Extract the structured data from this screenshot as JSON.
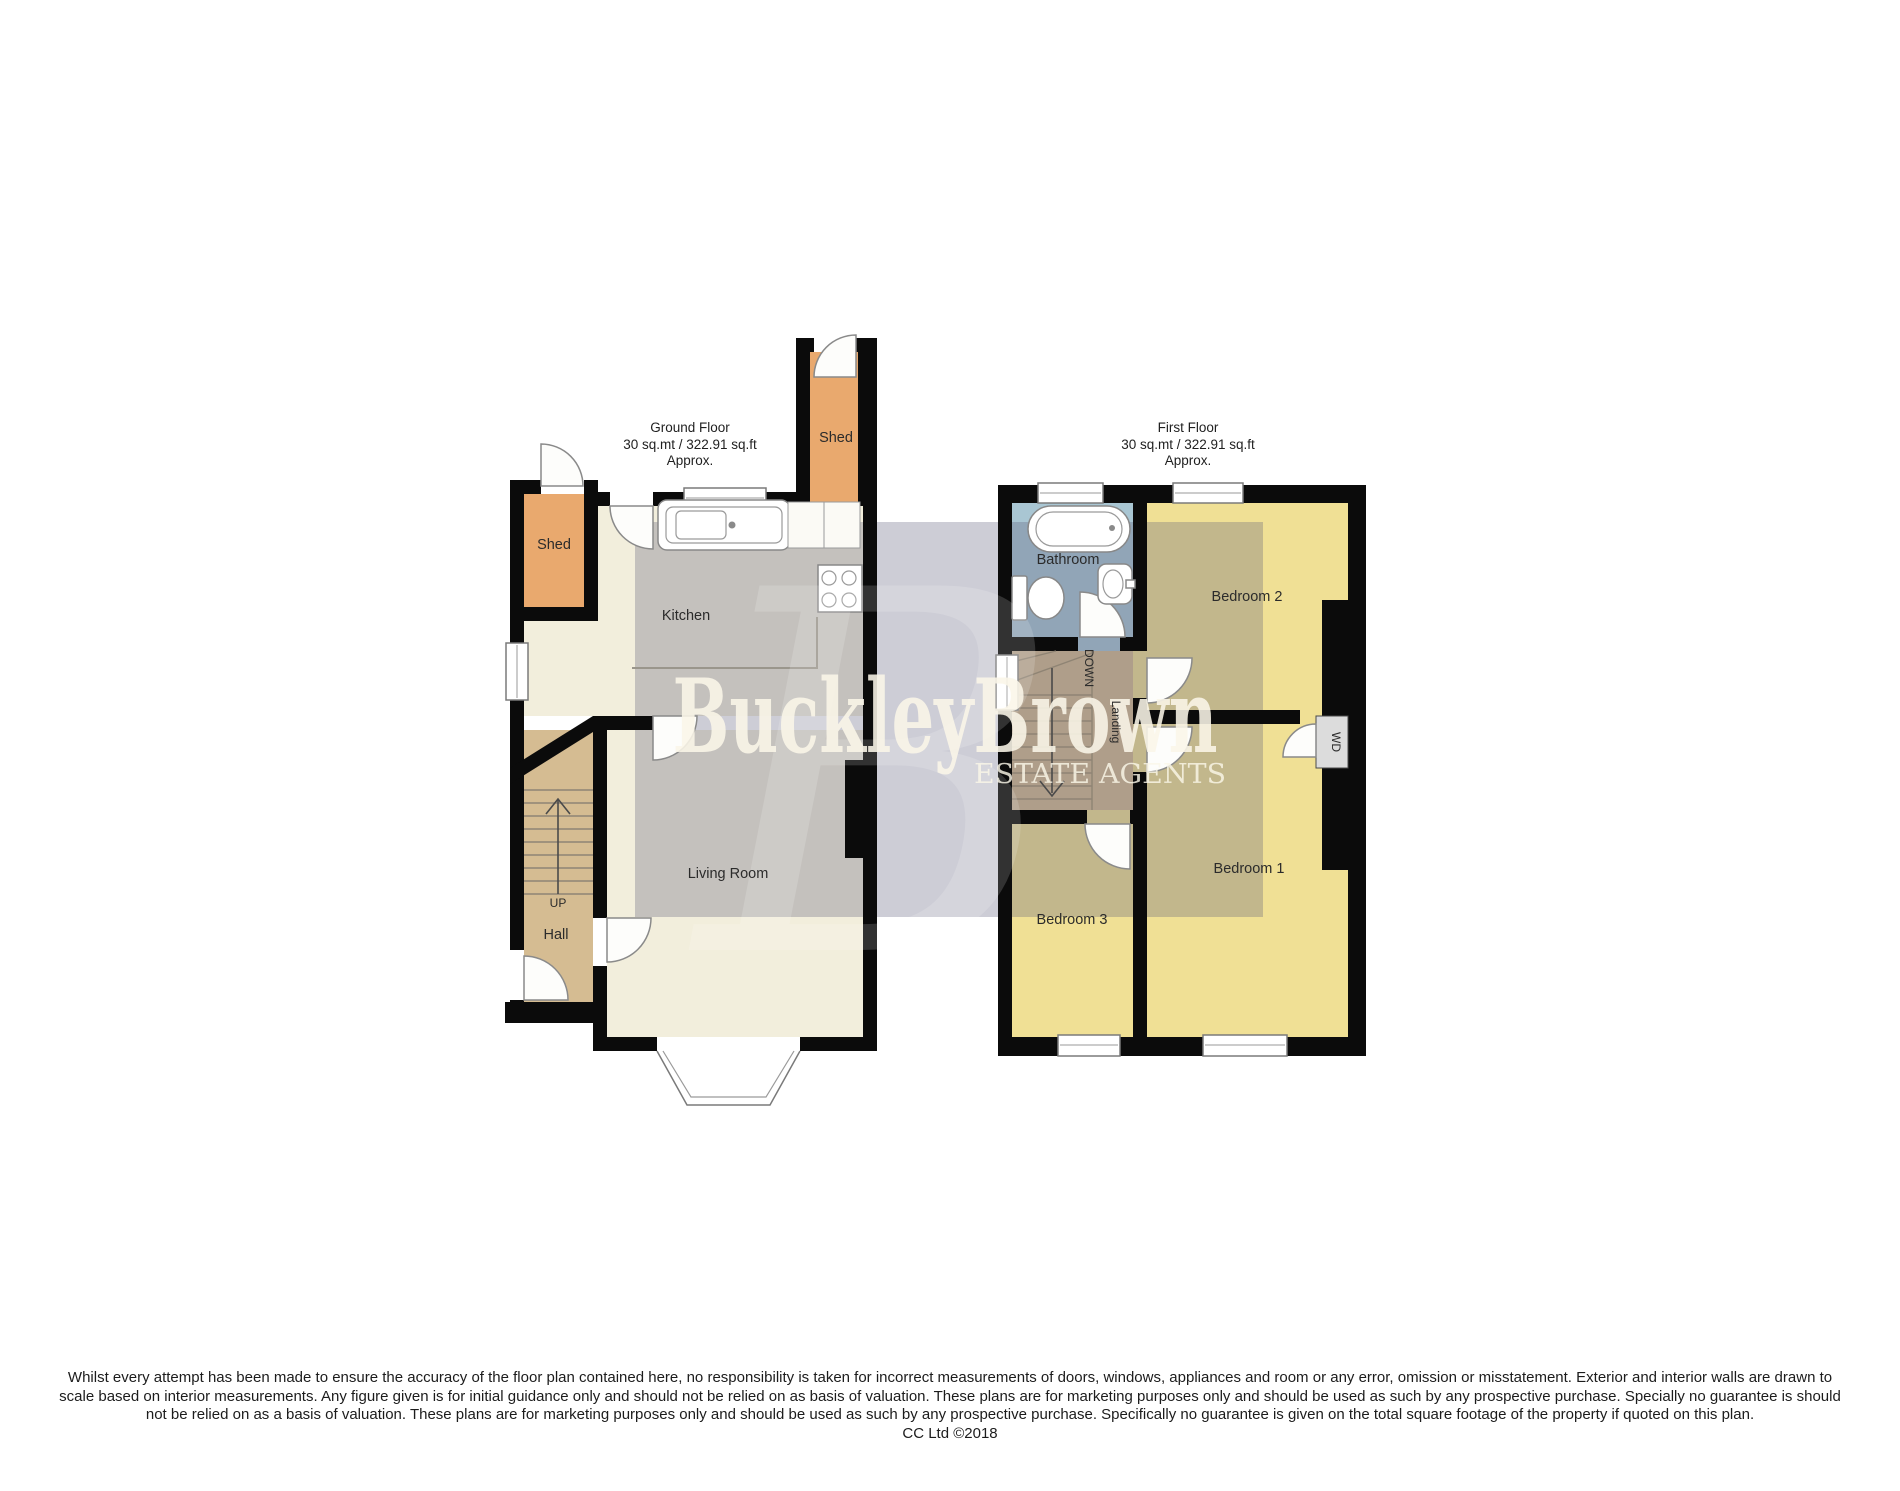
{
  "watermark": {
    "brand": "BuckleyBrown",
    "tagline": "ESTATE AGENTS",
    "ghost_letter": "B"
  },
  "ground_floor": {
    "title": "Ground Floor",
    "area": "30 sq.mt / 322.91 sq.ft",
    "approx": "Approx.",
    "labels": {
      "kitchen": "Kitchen",
      "living_room": "Living Room",
      "hall": "Hall",
      "shed_left": "Shed",
      "shed_top": "Shed",
      "stairs_direction": "UP"
    }
  },
  "first_floor": {
    "title": "First Floor",
    "area": "30 sq.mt / 322.91 sq.ft",
    "approx": "Approx.",
    "labels": {
      "bathroom": "Bathroom",
      "bedroom1": "Bedroom 1",
      "bedroom2": "Bedroom 2",
      "bedroom3": "Bedroom 3",
      "landing": "Landing",
      "stairs_direction": "DOWN",
      "wd": "WD"
    }
  },
  "disclaimer": {
    "line1": "Whilst every attempt has been made to ensure the accuracy of the floor plan contained here, no responsibility is taken for incorrect measurements of doors, windows, appliances and room or any error, omission or misstatement. Exterior and interior walls are drawn to",
    "line2": "scale based on interior measurements. Any figure given is for initial guidance only and should not be relied on as basis of valuation. These plans are for marketing purposes only and should be used as such by any prospective purchase. Specially no guarantee is should",
    "line3": "not be relied on as a basis of valuation. These plans are for marketing purposes only and should be used as such by any prospective purchase. Specifically no guarantee is given on the total square footage of the property if quoted on this plan.",
    "credit": "CC Ltd ©2018"
  },
  "colors": {
    "floor_cream": "#F2EEDC",
    "floor_yellow": "#F0E095",
    "hall_tan": "#D5BC92",
    "shed_orange": "#E9A96E",
    "bathroom_blue": "#A9C6D3",
    "wd_grey": "#DCDCDC",
    "wall_black": "#0B0B0B",
    "watermark_overlay": "rgba(88,88,118,0.30)",
    "brand_text": "#F8F4E6"
  }
}
